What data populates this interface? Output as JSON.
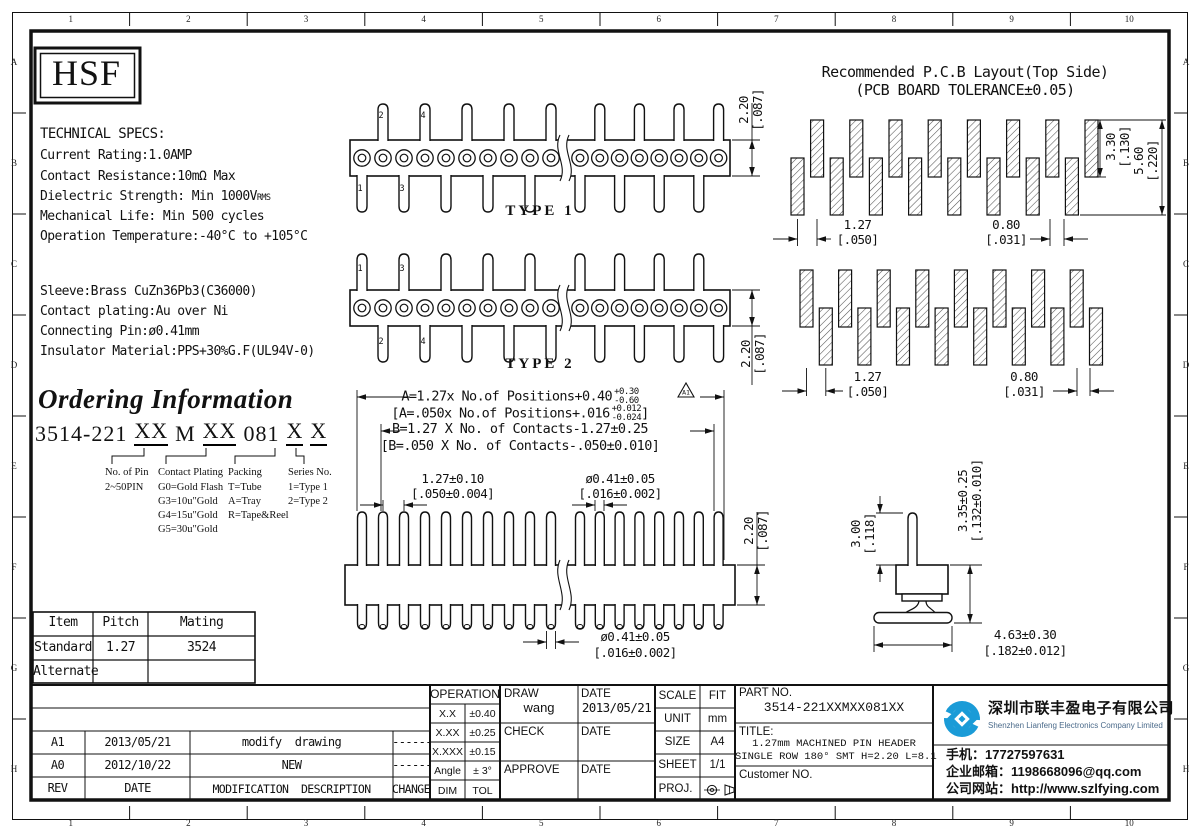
{
  "sheet": {
    "bg": "#ffffff",
    "line_color": "#111111",
    "accent_blue": "#1a9bd7"
  },
  "grid": {
    "cols": [
      "1",
      "2",
      "3",
      "4",
      "5",
      "6",
      "7",
      "8",
      "9",
      "10"
    ],
    "rows": [
      "A",
      "B",
      "C",
      "D",
      "E",
      "F",
      "G",
      "H"
    ]
  },
  "logo": {
    "text": "HSF"
  },
  "specs": {
    "title": "TECHNICAL SPECS:",
    "line1": "Current Rating:1.0AMP",
    "line2": "Contact Resistance:10mΩ Max",
    "line3a": "Dielectric Strength: Min 1000V",
    "line3b": "RMS",
    "line4": "Mechanical Life: Min 500 cycles",
    "line5": "Operation Temperature:-40°C to +105°C"
  },
  "materials": {
    "line1": "Sleeve:Brass CuZn36Pb3(C36000)",
    "line2": "Contact plating:Au over Ni",
    "line3": "Connecting Pin:ø0.41mm",
    "line4": "Insulator Material:PPS+30%G.F(UL94V-0)"
  },
  "ordering": {
    "heading": "Ordering Information",
    "seg1": "3514-221",
    "seg2": "XX",
    "seg3": "M",
    "seg4": "XX",
    "seg5": "081",
    "seg6": "X",
    "seg7": "X",
    "col1_title": "No. of Pin",
    "col1_item1": "2~50PIN",
    "col2_title": "Contact Plating",
    "col2_item1": "G0=Gold Flash",
    "col2_item2": "G3=10u\"Gold",
    "col2_item3": "G4=15u\"Gold",
    "col2_item4": "G5=30u\"Gold",
    "col3_title": "Packing",
    "col3_item1": "T=Tube",
    "col3_item2": "A=Tray",
    "col3_item3": "R=Tape&Reel",
    "col4_title": "Series No.",
    "col4_item1": "1=Type 1",
    "col4_item2": "2=Type 2"
  },
  "mating_table": {
    "h1": "Item",
    "h2": "Pitch",
    "h3": "Mating",
    "r1c1": "Standard",
    "r1c2": "1.27",
    "r1c3": "3524",
    "r2c1": "Alternate",
    "r2c2": "",
    "r2c3": ""
  },
  "revision_table": {
    "h_rev": "REV",
    "h_date": "DATE",
    "h_desc": "MODIFICATION  DESCRIPTION",
    "h_change": "CHANGE",
    "r1_rev": "A1",
    "r1_date": "2013/05/21",
    "r1_desc": "modify  drawing",
    "r1_change": "------",
    "r2_rev": "A0",
    "r2_date": "2012/10/22",
    "r2_desc": "NEW",
    "r2_change": "------"
  },
  "tolerance": {
    "title": "OPERATION",
    "r1a": "X.X",
    "r1b": "±0.40",
    "r2a": "X.XX",
    "r2b": "±0.25",
    "r3a": "X.XXX",
    "r3b": "±0.15",
    "r4a": "Angle",
    "r4b": "± 3°",
    "r5a": "DIM",
    "r5b": "TOL"
  },
  "approval": {
    "draw": "DRAW",
    "draw_name": "wang",
    "date1": "DATE",
    "date1_val": "2013/05/21",
    "check": "CHECK",
    "date2": "DATE",
    "approve": "APPROVE",
    "date3": "DATE"
  },
  "docinfo": {
    "scale": "SCALE",
    "scale_val": "FIT",
    "unit": "UNIT",
    "unit_val": "mm",
    "size": "SIZE",
    "size_val": "A4",
    "sheet": "SHEET",
    "sheet_val": "1/1",
    "proj": "PROJ."
  },
  "partblock": {
    "part_label": "PART NO.",
    "part_no": "3514-221XXMXX081XX",
    "title_label": "TITLE:",
    "title1": "1.27mm MACHINED PIN HEADER",
    "title2": "SINGLE ROW 180° SMT H=2.20 L=8.1",
    "customer": "Customer NO."
  },
  "company": {
    "name_cn": "深圳市联丰盈电子有限公司",
    "name_en": "Shenzhen Lianfeng Electronics Company Limited",
    "phone": "手机：17727597631",
    "email": "企业邮箱：1198668096@qq.com",
    "website": "公司网站：http://www.szlfying.com"
  },
  "drawings": {
    "type1": "TYPE 1",
    "type2": "TYPE 2",
    "pcb_title1": "Recommended P.C.B Layout(Top Side)",
    "pcb_title2": "(PCB BOARD TOLERANCE±0.05)",
    "pin_numbers": [
      "1",
      "2",
      "3",
      "4"
    ],
    "rev_flag": "A1",
    "f1": "A=1.27x No.of Positions+0.40",
    "f1_sup": "+0.30",
    "f1_sub": "-0.60",
    "f2": "[A=.050x No.of Positions+.016",
    "f2_sup": "+0.012",
    "f2_sub": "-0.024",
    "f2_end": "]",
    "f3": "B=1.27 X No. of Contacts-1.27±0.25",
    "f4": "[B=.050 X No. of Contacts-.050±0.010]",
    "dim_220": "2.20",
    "dim_220_in": "[.087]",
    "dim_127": "1.27",
    "dim_127_in": "[.050]",
    "dim_080": "0.80",
    "dim_080_in": "[.031]",
    "dim_330": "3.30",
    "dim_330_in": "[.130]",
    "dim_560": "5.60",
    "dim_560_in": "[.220]",
    "dim_pitch": "1.27±0.10",
    "dim_pitch_in": "[.050±0.004]",
    "dim_dia": "ø0.41±0.05",
    "dim_dia_in": "[.016±0.002]",
    "dim_300": "3.00",
    "dim_300_in": "[.118]",
    "dim_335": "3.35±0.25",
    "dim_335_in": "[.132±0.010]",
    "dim_463": "4.63±0.30",
    "dim_463_in": "[.182±0.012]"
  }
}
